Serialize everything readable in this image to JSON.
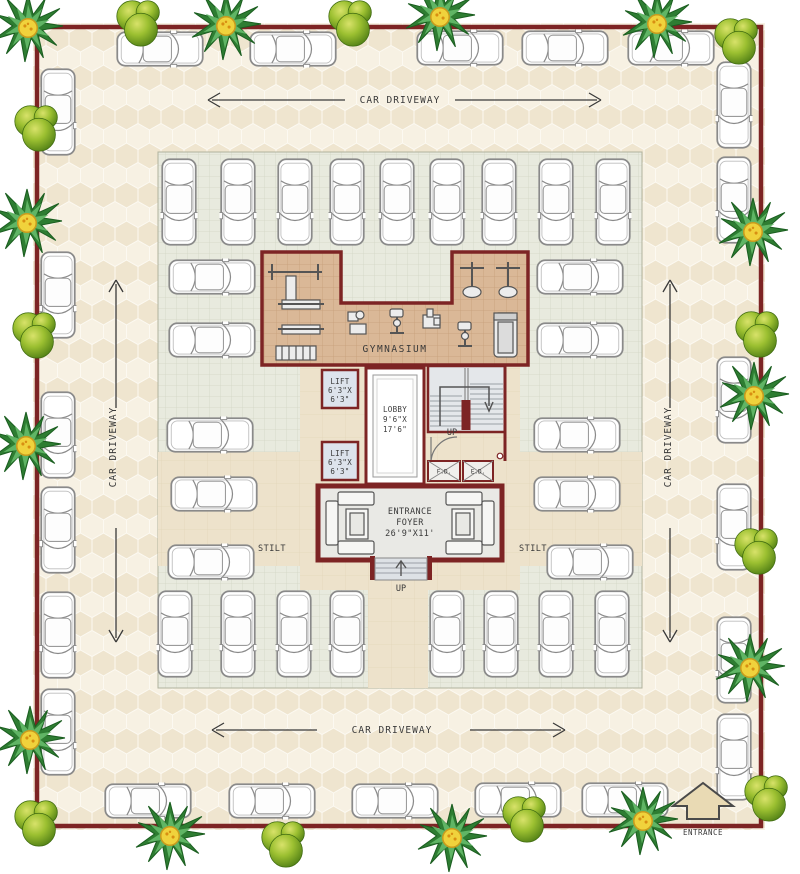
{
  "labels": {
    "driveway_top": "CAR DRIVEWAY",
    "driveway_bottom": "CAR DRIVEWAY",
    "driveway_left": "CAR DRIVEWAY",
    "driveway_right": "CAR DRIVEWAY",
    "gymnasium": "GYMNASIUM",
    "lift_upper": {
      "l1": "LIFT",
      "l2": "6'3\"X",
      "l3": "6'3\""
    },
    "lift_lower": {
      "l1": "LIFT",
      "l2": "6'3\"X",
      "l3": "6'3\""
    },
    "lobby": {
      "l1": "LOBBY",
      "l2": "9'6\"X",
      "l3": "17'6\""
    },
    "stairs_up": "UP",
    "duct_left": "F.D.",
    "duct_right": "E.D.",
    "foyer": {
      "l1": "ENTRANCE",
      "l2": "FOYER",
      "l3": "26'9\"X11'"
    },
    "steps_up": "UP",
    "stilt_left": "STILT",
    "stilt_right": "STILT",
    "entrance": "ENTRANCE"
  },
  "colors": {
    "compound_wall": "#7d2424",
    "paving_base": "#f4eddd",
    "paving_hex_dark": "#efe5cf",
    "paving_hex_light": "#f7f1e3",
    "stilt_floor": "#e8eade",
    "stilt_grid": "#d2d5c4",
    "gym_floor": "#dab897",
    "gym_grid": "#c79e79",
    "apron": "#ede2cb",
    "car_body": "#ffffff",
    "car_outline": "#8a8a8a",
    "round_tree_green": "#6fa224",
    "palm_green": "#2e7d32",
    "palm_center_yellow": "#f0d23c",
    "text": "#3a3a3a"
  },
  "icons": {
    "car": "car-icon",
    "round_tree": "round-tree-icon",
    "palm_plant": "palm-plant-icon",
    "entrance_arrow": "entrance-arrow-icon",
    "stairs_direction": "stairs-direction-arrow",
    "driveway_arrows": "driveway-direction-arrows",
    "steps_direction": "steps-direction-arrow"
  }
}
